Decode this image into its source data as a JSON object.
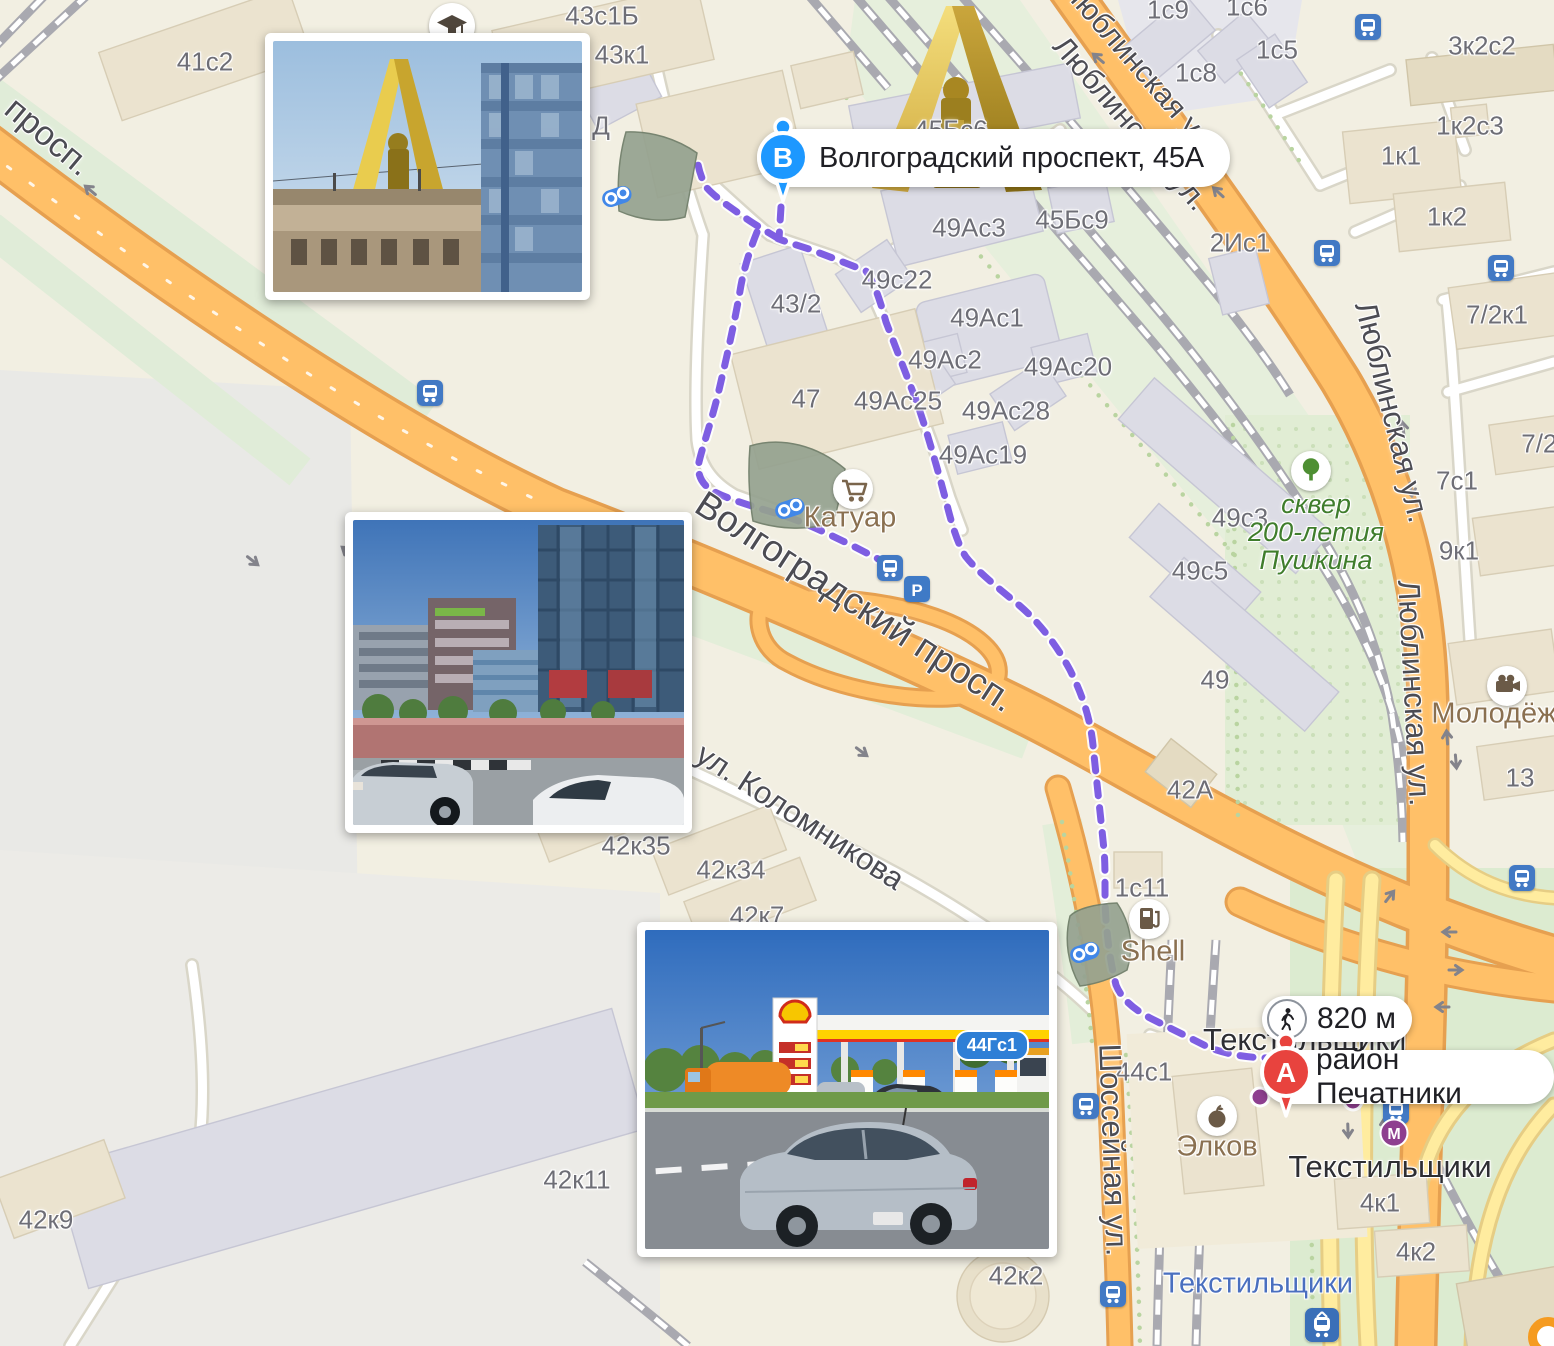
{
  "map": {
    "route": {
      "distance_label": "820 м",
      "color": "#7e5ee2"
    },
    "markers": {
      "b": {
        "letter": "В",
        "label": "Волгоградский проспект, 45А",
        "color": "#1d98ff"
      },
      "a": {
        "letter": "А",
        "label": "район Печатники",
        "color": "#e8433e"
      }
    },
    "colors": {
      "road_major": "#ffc068",
      "road_ramp": "#ffec9f",
      "land": "#f2efe2",
      "park": "#e1edd4",
      "building_gray": "#dcdce5",
      "building_beige": "#ebe3cf",
      "metro_line": "#8e3f8f",
      "transit_blue": "#4279c4"
    },
    "labels": [
      {
        "t": "41с2",
        "x": 205,
        "y": 62,
        "c": "lb"
      },
      {
        "t": "43к1",
        "x": 622,
        "y": 55,
        "c": "lb"
      },
      {
        "t": "43с1Б",
        "x": 602,
        "y": 16,
        "c": "lb"
      },
      {
        "t": "Д",
        "x": 601,
        "y": 126,
        "c": "lb"
      },
      {
        "t": "45Бс6",
        "x": 951,
        "y": 130,
        "c": "lb"
      },
      {
        "t": "45Бс9",
        "x": 1072,
        "y": 220,
        "c": "lb"
      },
      {
        "t": "49Ас3",
        "x": 969,
        "y": 228,
        "c": "lb"
      },
      {
        "t": "49с22",
        "x": 897,
        "y": 280,
        "c": "lb"
      },
      {
        "t": "43/2",
        "x": 796,
        "y": 304,
        "c": "lb"
      },
      {
        "t": "49Ас1",
        "x": 987,
        "y": 318,
        "c": "lb"
      },
      {
        "t": "49Ас2",
        "x": 945,
        "y": 360,
        "c": "lb"
      },
      {
        "t": "49Ас20",
        "x": 1068,
        "y": 367,
        "c": "lb"
      },
      {
        "t": "49Ас25",
        "x": 898,
        "y": 401,
        "c": "lb"
      },
      {
        "t": "49Ас28",
        "x": 1006,
        "y": 411,
        "c": "lb"
      },
      {
        "t": "49Ас19",
        "x": 983,
        "y": 455,
        "c": "lb"
      },
      {
        "t": "47",
        "x": 806,
        "y": 399,
        "c": "lb"
      },
      {
        "t": "49с3",
        "x": 1240,
        "y": 518,
        "c": "lb"
      },
      {
        "t": "49с5",
        "x": 1200,
        "y": 571,
        "c": "lb"
      },
      {
        "t": "49",
        "x": 1215,
        "y": 680,
        "c": "lb"
      },
      {
        "t": "2Ис1",
        "x": 1240,
        "y": 243,
        "c": "lb"
      },
      {
        "t": "1с9",
        "x": 1168,
        "y": 10,
        "c": "lb"
      },
      {
        "t": "1с6",
        "x": 1247,
        "y": 7,
        "c": "lb"
      },
      {
        "t": "1с5",
        "x": 1277,
        "y": 50,
        "c": "lb"
      },
      {
        "t": "1с8",
        "x": 1196,
        "y": 73,
        "c": "lb"
      },
      {
        "t": "3к2с2",
        "x": 1482,
        "y": 46,
        "c": "lb"
      },
      {
        "t": "1к2с3",
        "x": 1470,
        "y": 126,
        "c": "lb"
      },
      {
        "t": "1к1",
        "x": 1401,
        "y": 156,
        "c": "lb"
      },
      {
        "t": "1к2",
        "x": 1447,
        "y": 217,
        "c": "lb"
      },
      {
        "t": "7/2к1",
        "x": 1497,
        "y": 315,
        "c": "lb"
      },
      {
        "t": "7/2к",
        "x": 1545,
        "y": 444,
        "c": "lb"
      },
      {
        "t": "7с1",
        "x": 1457,
        "y": 481,
        "c": "lb"
      },
      {
        "t": "9к1",
        "x": 1459,
        "y": 551,
        "c": "lb"
      },
      {
        "t": "13",
        "x": 1520,
        "y": 778,
        "c": "lb"
      },
      {
        "t": "42А",
        "x": 1190,
        "y": 790,
        "c": "lb"
      },
      {
        "t": "42к35",
        "x": 636,
        "y": 846,
        "c": "lb"
      },
      {
        "t": "42к34",
        "x": 731,
        "y": 870,
        "c": "lb"
      },
      {
        "t": "42к7",
        "x": 757,
        "y": 916,
        "c": "lb"
      },
      {
        "t": "42к11",
        "x": 577,
        "y": 1180,
        "c": "lb"
      },
      {
        "t": "42к9",
        "x": 46,
        "y": 1220,
        "c": "lb"
      },
      {
        "t": "42к2",
        "x": 1016,
        "y": 1276,
        "c": "lb"
      },
      {
        "t": "1с11",
        "x": 1142,
        "y": 888,
        "c": "lb"
      },
      {
        "t": "44с1",
        "x": 1144,
        "y": 1072,
        "c": "lb"
      },
      {
        "t": "4к1",
        "x": 1380,
        "y": 1203,
        "c": "lb"
      },
      {
        "t": "4к2",
        "x": 1416,
        "y": 1252,
        "c": "lb"
      },
      {
        "t": "просп.",
        "x": 48,
        "y": 137,
        "c": "lst",
        "r": 40,
        "s": 34
      },
      {
        "t": "Волгоградский просп.",
        "x": 855,
        "y": 602,
        "c": "lst",
        "r": 33,
        "s": 37
      },
      {
        "t": "ул. Коломникова",
        "x": 800,
        "y": 817,
        "c": "lst",
        "r": 33,
        "s": 31
      },
      {
        "t": "Люблинская ул.",
        "x": 1140,
        "y": 68,
        "c": "lst",
        "r": 49,
        "s": 30
      },
      {
        "t": "Люблинская ул.",
        "x": 1130,
        "y": 124,
        "c": "lst",
        "r": 49,
        "s": 30
      },
      {
        "t": "Люблинская ул.",
        "x": 1392,
        "y": 412,
        "c": "lst",
        "r": 76,
        "s": 31
      },
      {
        "t": "Люблинская ул.",
        "x": 1414,
        "y": 693,
        "c": "lst",
        "r": 87,
        "s": 31
      },
      {
        "t": "Шоссейная ул.",
        "x": 1113,
        "y": 1150,
        "c": "lst",
        "r": 88,
        "s": 31
      },
      {
        "t": "Катуар",
        "x": 850,
        "y": 518,
        "c": "lpoi"
      },
      {
        "t": "Shell",
        "x": 1153,
        "y": 952,
        "c": "lpoi"
      },
      {
        "t": "Элков",
        "x": 1217,
        "y": 1147,
        "c": "lpoi"
      },
      {
        "t": "Молодёжн",
        "x": 1502,
        "y": 714,
        "c": "lpoi"
      },
      {
        "t": "сквер\n200-летия\nПушкина",
        "x": 1316,
        "y": 532,
        "c": "lgrn"
      },
      {
        "t": "Текстильщики",
        "x": 1390,
        "y": 1167,
        "c": "lstB"
      },
      {
        "t": "Текстильщики",
        "x": 1203,
        "y": 1040,
        "c": "lstB",
        "a": "left"
      },
      {
        "t": "Текстильщики",
        "x": 1258,
        "y": 1284,
        "c": "lstU"
      }
    ],
    "icons": [
      {
        "k": "bus-stop",
        "x": 430,
        "y": 393
      },
      {
        "k": "bus-stop",
        "x": 890,
        "y": 568
      },
      {
        "k": "bus-stop",
        "x": 1327,
        "y": 253
      },
      {
        "k": "bus-stop",
        "x": 1501,
        "y": 268
      },
      {
        "k": "bus-stop",
        "x": 1368,
        "y": 27
      },
      {
        "k": "bus-stop",
        "x": 1522,
        "y": 878
      },
      {
        "k": "bus-stop",
        "x": 1396,
        "y": 1111
      },
      {
        "k": "bus-stop",
        "x": 1086,
        "y": 1106
      },
      {
        "k": "bus-stop",
        "x": 1113,
        "y": 1294
      },
      {
        "k": "train-station",
        "x": 1322,
        "y": 1325
      },
      {
        "k": "metro-m",
        "x": 1394,
        "y": 1133
      },
      {
        "k": "metro-exit",
        "x": 1353,
        "y": 1101
      },
      {
        "k": "metro-exit",
        "x": 1260,
        "y": 1097
      },
      {
        "k": "parking",
        "x": 917,
        "y": 589
      },
      {
        "k": "binoculars",
        "x": 617,
        "y": 197
      },
      {
        "k": "binoculars",
        "x": 790,
        "y": 509
      },
      {
        "k": "binoculars",
        "x": 1085,
        "y": 953
      },
      {
        "k": "school",
        "x": 452,
        "y": 26
      },
      {
        "k": "shopping-cart",
        "x": 853,
        "y": 489
      },
      {
        "k": "fuel",
        "x": 1149,
        "y": 919
      },
      {
        "k": "apple",
        "x": 1217,
        "y": 1116
      },
      {
        "k": "video-camera",
        "x": 1507,
        "y": 686
      },
      {
        "k": "tree",
        "x": 1311,
        "y": 471
      },
      {
        "k": "brand-logo",
        "x": 1548,
        "y": 1337
      }
    ]
  },
  "photos": [
    {
      "name": "street-photo-monument",
      "badge": ""
    },
    {
      "name": "street-photo-offices",
      "badge": ""
    },
    {
      "name": "street-photo-shell-station",
      "badge": "44Гс1"
    }
  ]
}
